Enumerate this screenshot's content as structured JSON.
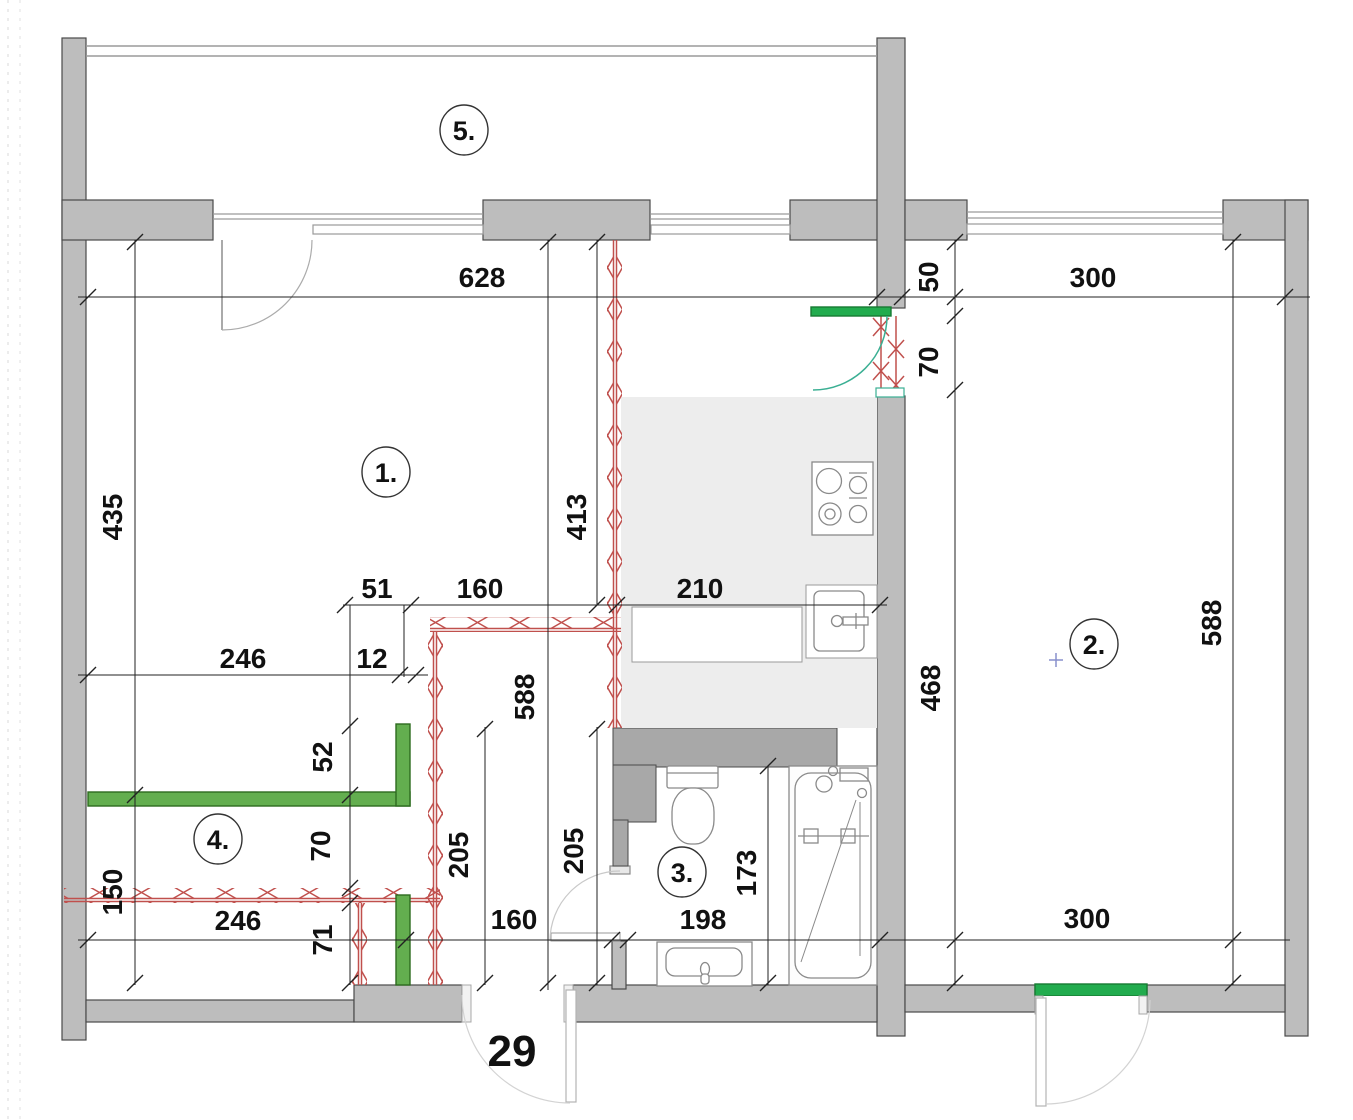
{
  "drawing": {
    "type": "apartment-floor-plan",
    "apartment_number": "29"
  },
  "rooms": [
    {
      "id": "room-1",
      "label": "1."
    },
    {
      "id": "room-2",
      "label": "2."
    },
    {
      "id": "room-3",
      "label": "3."
    },
    {
      "id": "room-4",
      "label": "4."
    },
    {
      "id": "room-5",
      "label": "5."
    }
  ],
  "dimensions": {
    "d628": "628",
    "d50": "50",
    "d300_top": "300",
    "d70_top": "70",
    "d435": "435",
    "d413": "413",
    "d51": "51",
    "d160_mid": "160",
    "d210": "210",
    "d588_left": "588",
    "d246_top": "246",
    "d12": "12",
    "d52": "52",
    "d70_mid": "70",
    "d468": "468",
    "d588_right": "588",
    "d205_left": "205",
    "d205_right": "205",
    "d150": "150",
    "d246_bottom": "246",
    "d71": "71",
    "d160_bottom": "160",
    "d198": "198",
    "d173": "173",
    "d300_bottom": "300"
  },
  "legend_colors": {
    "existing_wall_gray": "#bdbdbd",
    "duct_dark_gray": "#a8a8a8",
    "kitchen_floor_gray": "#ededed",
    "demolished_wall_red": "#c0504d",
    "new_wall_green": "#63ae4f",
    "new_lintel_green": "#22ac4e",
    "door_swing_teal": "#3aaf93",
    "center_mark_blue": "#8890cc"
  }
}
